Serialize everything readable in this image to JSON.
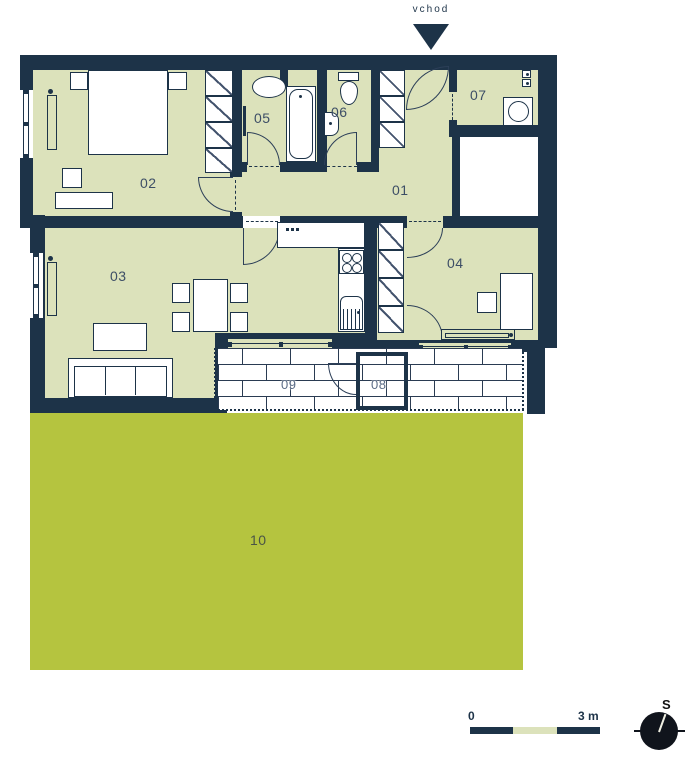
{
  "entrance": {
    "label": "vchod"
  },
  "rooms": {
    "r01": "01",
    "r02": "02",
    "r03": "03",
    "r04": "04",
    "r05": "05",
    "r06": "06",
    "r07": "07",
    "r08": "08",
    "r09": "09",
    "r10": "10"
  },
  "legend": {
    "scale_start": "0",
    "scale_end": "3 m",
    "compass_north": "S"
  },
  "colors": {
    "wall": "#1d3348",
    "room_floor": "#dce2bb",
    "garden": "#b5c43f",
    "paving": "#ffffff"
  }
}
